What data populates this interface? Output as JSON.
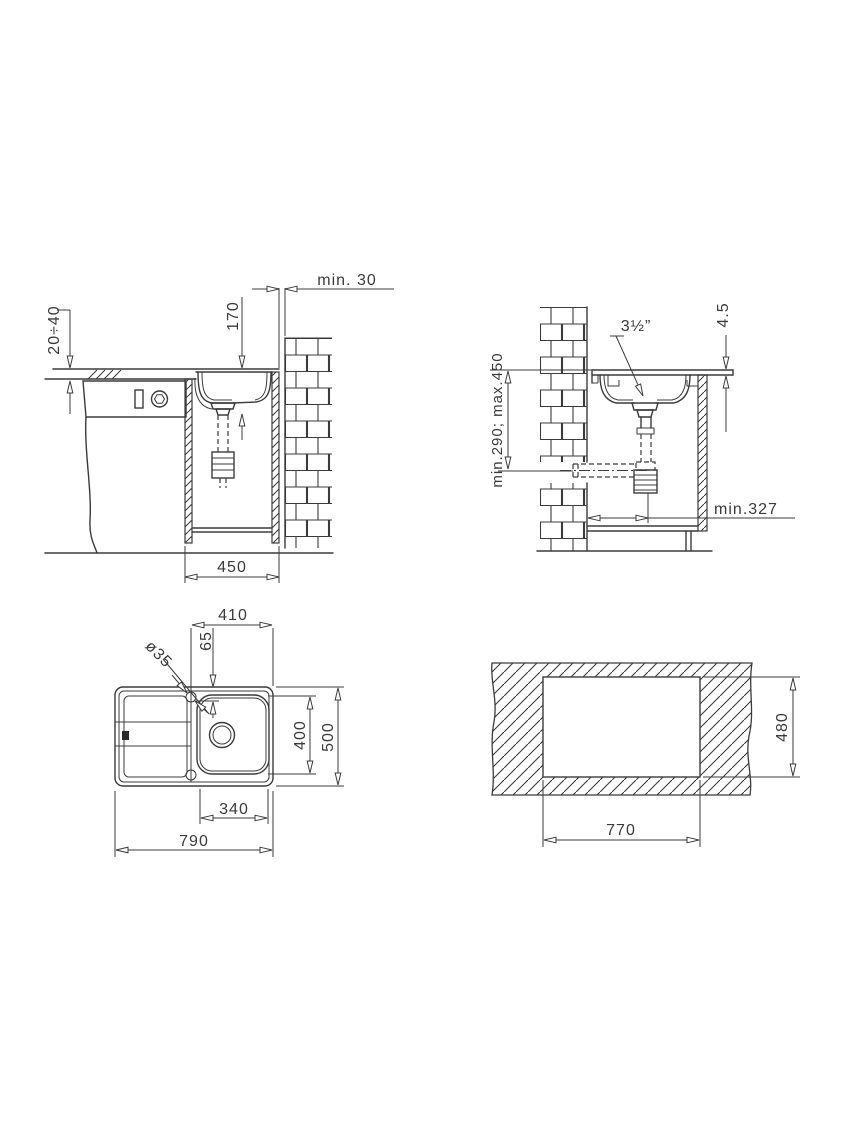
{
  "drawing": {
    "line_color": "#3b3b3b",
    "background_color": "#ffffff",
    "front_section": {
      "wall_gap": "min. 30",
      "bowl_depth": "170",
      "worktop_thickness": "20÷40",
      "cabinet_width": "450"
    },
    "side_section": {
      "drain_diameter": "3½”",
      "rim_height": "4.5",
      "drain_outlet_height": "min.290; max.450",
      "drain_wall_distance": "min.327"
    },
    "top_view": {
      "bowl_zone_width": "410",
      "tap_hole_offset": "65",
      "tap_hole_diameter": "ø35",
      "bowl_length": "400",
      "sink_width": "500",
      "bowl_inner_length": "340",
      "sink_length": "790"
    },
    "cutout_view": {
      "cutout_depth": "480",
      "cutout_width": "770"
    }
  }
}
